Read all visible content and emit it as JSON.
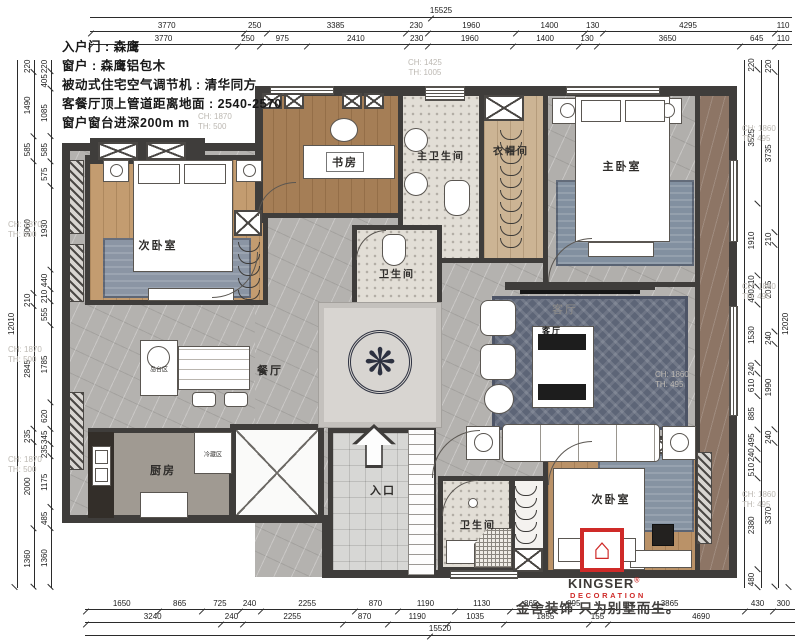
{
  "notes": [
    "入户门 : 森鹰",
    "窗户 : 森鹰铝包木",
    "被动式住宅空气调节机 : 清华同方",
    "客餐厅顶上管道距离地面 : 2540-2570",
    "窗户窗台进深200m m"
  ],
  "rooms": {
    "second_bedroom_top": "次卧室",
    "study": "书房",
    "master_bathroom": "主卫生间",
    "cloakroom": "衣帽间",
    "master_bedroom": "主卧室",
    "bathroom_mid": "卫生间",
    "living_room": "客厅",
    "living_room_small": "客厅",
    "dining_room": "餐厅",
    "kitchen": "厨房",
    "entrance": "入口",
    "bathroom_bottom": "卫生间",
    "second_bedroom_bottom": "次卧室"
  },
  "zones": {
    "island": "岛台区",
    "fridge": "冷藏区"
  },
  "annotations": {
    "win_top": {
      "ch": "CH: 1425",
      "th": "TH: 1005"
    },
    "win_left": {
      "ch": "CH: 1870",
      "th": "TH: 500"
    },
    "win_right": {
      "ch": "CH: 1860",
      "th": "TH: 495"
    }
  },
  "dims": {
    "top": {
      "total": "15525",
      "row1": [
        "3770",
        "250",
        "3385",
        "230",
        "1960",
        "1400",
        "130",
        "4295",
        "110"
      ],
      "row2": [
        "3770",
        "250",
        "975",
        "2410",
        "230",
        "1960",
        "1400",
        "130",
        "3650",
        "645",
        "110"
      ]
    },
    "bottom": {
      "row1": [
        "1650",
        "865",
        "725",
        "240",
        "2255",
        "870",
        "1190",
        "1130",
        "865",
        "895",
        "3865",
        "430",
        "300"
      ],
      "row2": [
        "3240",
        "240",
        "2255",
        "870",
        "1190",
        "1035",
        "1855",
        "155",
        "4690"
      ],
      "total": "15520"
    },
    "left": {
      "total": "12010",
      "outer": [
        "220",
        "1490",
        "585",
        "3060",
        "210",
        "2845",
        "235",
        "2000",
        "1360"
      ],
      "inner": [
        "220",
        "405",
        "1085",
        "585",
        "575",
        "1930",
        "440",
        "210",
        "555",
        "1785",
        "620",
        "345",
        "235",
        "1175",
        "485",
        "1360"
      ]
    },
    "right": {
      "inner": [
        "220",
        "3525",
        "1910",
        "210",
        "490",
        "1530",
        "240",
        "610",
        "885",
        "495",
        "240",
        "510",
        "2380",
        "480"
      ],
      "outer": [
        "220",
        "3735",
        "210",
        "2015",
        "240",
        "1990",
        "240",
        "3370"
      ],
      "total": "12020"
    }
  },
  "branding": {
    "brand": "KINGSER",
    "reg": "®",
    "sub": "DECORATION",
    "accent": "#cf2a28",
    "slogan": "金舍装饰 只为别墅而生。"
  },
  "icons": {
    "medallion": "❋",
    "logo_house": "⌂"
  }
}
